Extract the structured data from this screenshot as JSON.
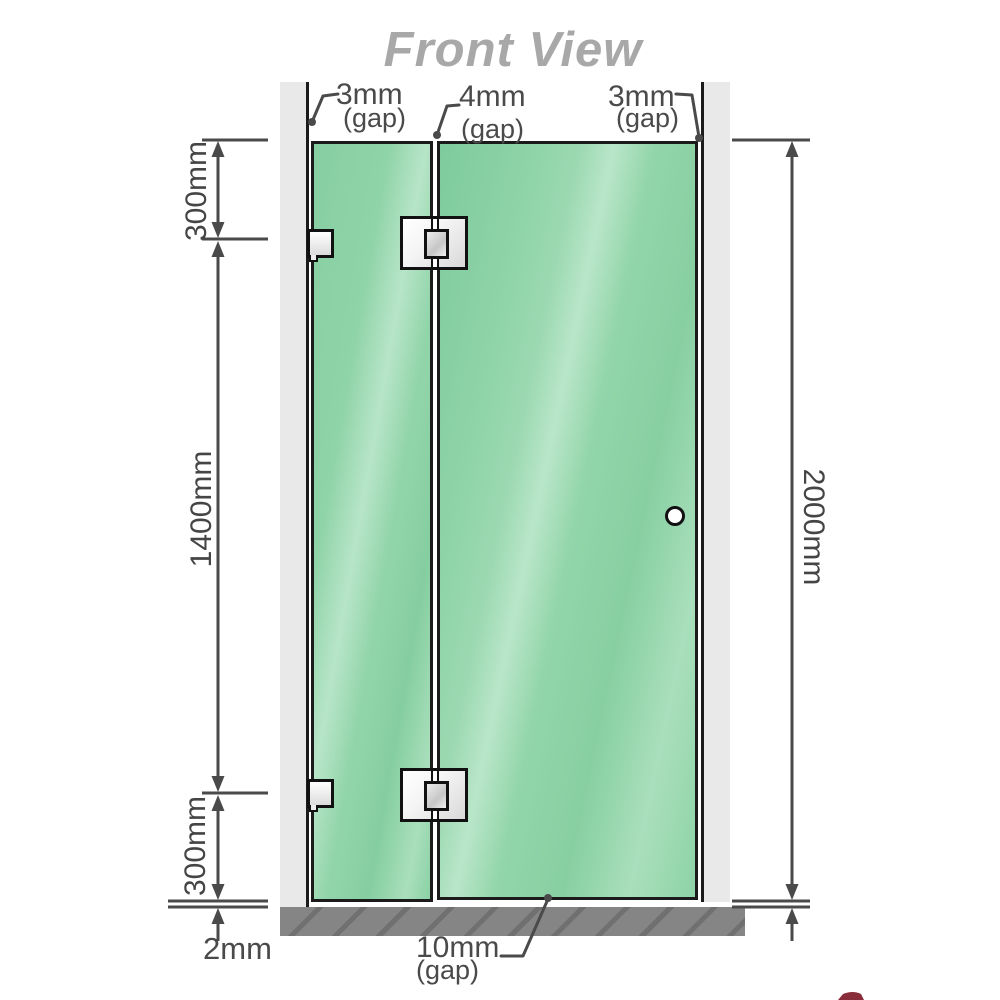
{
  "title": "Front View",
  "gaps": {
    "top_left": {
      "value": "3mm",
      "note": "(gap)"
    },
    "top_middle": {
      "value": "4mm",
      "note": "(gap)"
    },
    "top_right": {
      "value": "3mm",
      "note": "(gap)"
    },
    "bottom_middle": {
      "value": "10mm",
      "note": "(gap)"
    },
    "bottom_left": {
      "value": "2mm"
    }
  },
  "dimensions": {
    "left_top": "300mm",
    "left_middle": "1400mm",
    "left_bottom": "300mm",
    "right_height": "2000mm"
  },
  "colors": {
    "glass_green": "#8ed3a8",
    "glass_highlight": "#b9e6c9",
    "wall_gray": "#e9e9e9",
    "floor_gray": "#858585",
    "line_gray": "#4a4a4a",
    "panel_border": "#1b1b1b",
    "title_gray": "#a8a8a8",
    "logo_red": "#7c1626"
  }
}
